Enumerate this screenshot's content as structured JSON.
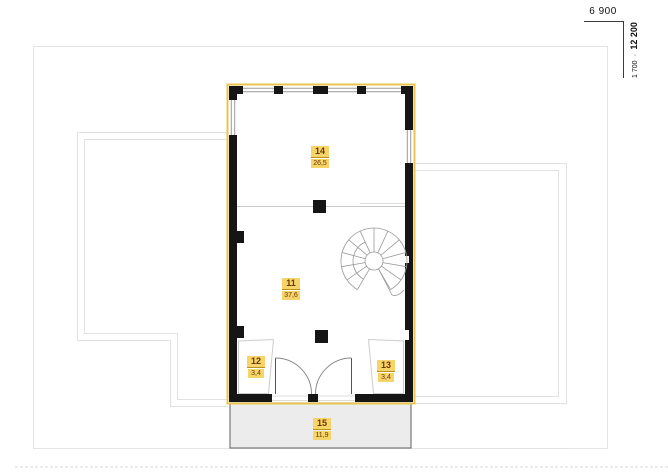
{
  "dimensions": {
    "width_label": "6 900",
    "height_part_label": "1 700",
    "separator": "∙",
    "height_total_label": "12 200"
  },
  "rooms": [
    {
      "number": "14",
      "area": "26,5"
    },
    {
      "number": "11",
      "area": "37,6"
    },
    {
      "number": "12",
      "area": "3,4"
    },
    {
      "number": "13",
      "area": "3,4"
    },
    {
      "number": "15",
      "area": "11,9"
    }
  ],
  "colors": {
    "plan_outline_accent": "#e9c44f",
    "room_label_background": "#f5d469",
    "room_label_text": "#6e3600",
    "wall": "#151515",
    "roof_outline": "#e2e2e2",
    "porch_fill": "#ececec"
  }
}
